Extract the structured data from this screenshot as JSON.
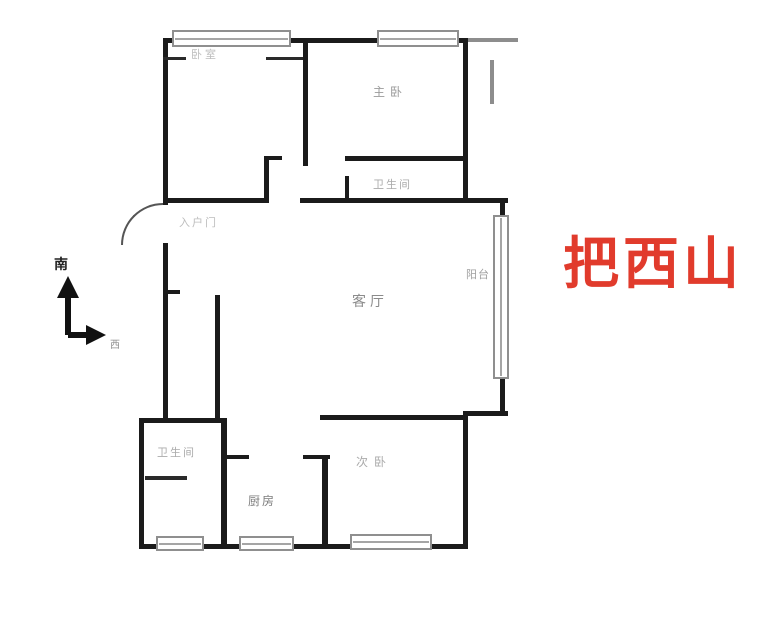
{
  "title": "apartment-floor-plan",
  "watermark": {
    "text": "把西山",
    "color": "#e13b2c"
  },
  "compass": {
    "south_label": "南",
    "west_label": "西"
  },
  "rooms": [
    {
      "id": "bedroom-top-left",
      "label": "卧室"
    },
    {
      "id": "master-bedroom",
      "label": "主卧"
    },
    {
      "id": "bathroom-top",
      "label": "卫生间"
    },
    {
      "id": "balcony",
      "label": "阳台"
    },
    {
      "id": "living-room",
      "label": "客厅"
    },
    {
      "id": "entry-door",
      "label": "入户门"
    },
    {
      "id": "bathroom-bottom",
      "label": "卫生间"
    },
    {
      "id": "kitchen",
      "label": "厨房"
    },
    {
      "id": "second-bedroom",
      "label": "次卧"
    }
  ],
  "colors": {
    "wall": "#1b1b1b",
    "window_frame": "#8f8f8f",
    "label_text": "#a9a9a9"
  }
}
